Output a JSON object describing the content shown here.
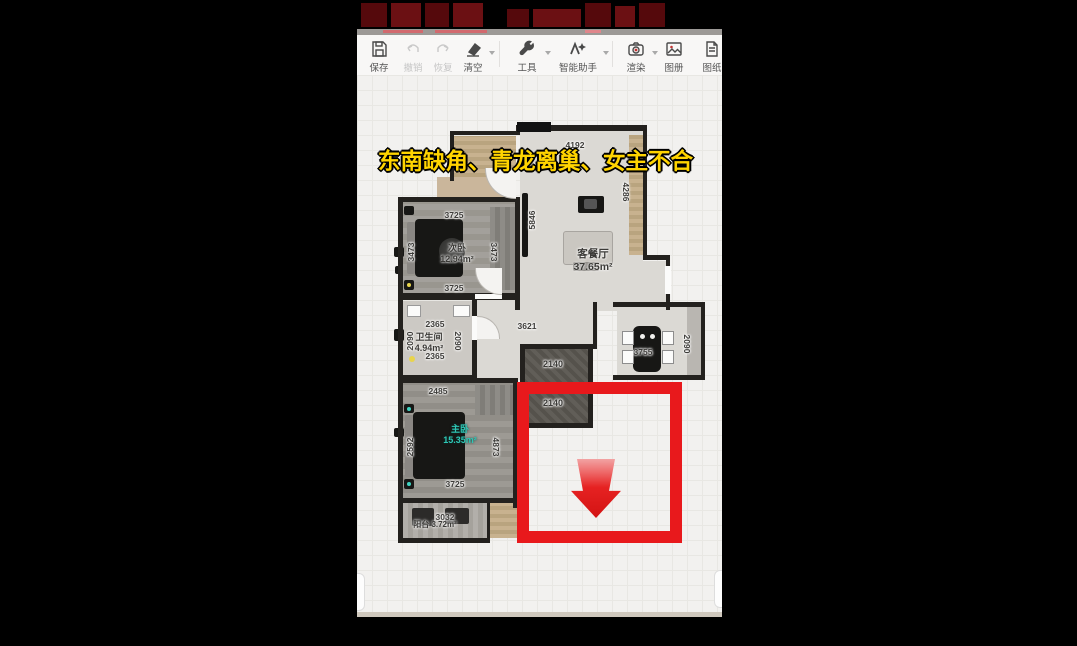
{
  "caption": {
    "text": "东南缺角、青龙离巢、女主不合",
    "color": "#ffd400"
  },
  "toolbar": {
    "items": [
      {
        "label": "保存",
        "icon": "save-icon",
        "disabled": false,
        "caret": false
      },
      {
        "label": "撤销",
        "icon": "undo-icon",
        "disabled": true,
        "caret": false
      },
      {
        "label": "恢复",
        "icon": "redo-icon",
        "disabled": true,
        "caret": false
      },
      {
        "label": "清空",
        "icon": "eraser-icon",
        "disabled": false,
        "caret": true
      },
      {
        "label": "工具",
        "icon": "wrench-icon",
        "disabled": false,
        "caret": true
      },
      {
        "label": "智能助手",
        "icon": "ai-assistant-icon",
        "disabled": false,
        "caret": true
      },
      {
        "label": "渲染",
        "icon": "render-camera-icon",
        "disabled": false,
        "caret": true
      },
      {
        "label": "图册",
        "icon": "album-icon",
        "disabled": false,
        "caret": false
      },
      {
        "label": "图纸",
        "icon": "drawing-sheet-icon",
        "disabled": false,
        "caret": false
      }
    ]
  },
  "floorplan": {
    "rooms": [
      {
        "name": "客餐厅",
        "area": "37.65m²"
      },
      {
        "name": "次卧",
        "area": "12.94m²"
      },
      {
        "name": "卫生间",
        "area": "4.94m²"
      },
      {
        "name": "主卧",
        "area": "15.35m²"
      },
      {
        "name": "阳台",
        "area": "3.72m²"
      }
    ],
    "dims": {
      "living_top": "4192",
      "living_right": "4286",
      "living_left": "5846",
      "bed2_top": "3725",
      "bed2_right": "3473",
      "bed2_left": "3473",
      "bed2_bottom": "3725",
      "bath_top": "2365",
      "bath_left": "2090",
      "bath_right": "2090",
      "bath_bottom": "2365",
      "hallway": "3621",
      "store_top": "2140",
      "store_bottom": "2140",
      "dining_width": "3755",
      "kitchen_right": "2090",
      "master_top": "2485",
      "master_right": "4873",
      "master_left": "2592",
      "master_bottom": "3725",
      "balcony_width": "3032"
    }
  },
  "colors": {
    "annotation_red": "#e8191c",
    "caption_yellow": "#ffd400",
    "master_label_teal": "#2fc7b6"
  }
}
